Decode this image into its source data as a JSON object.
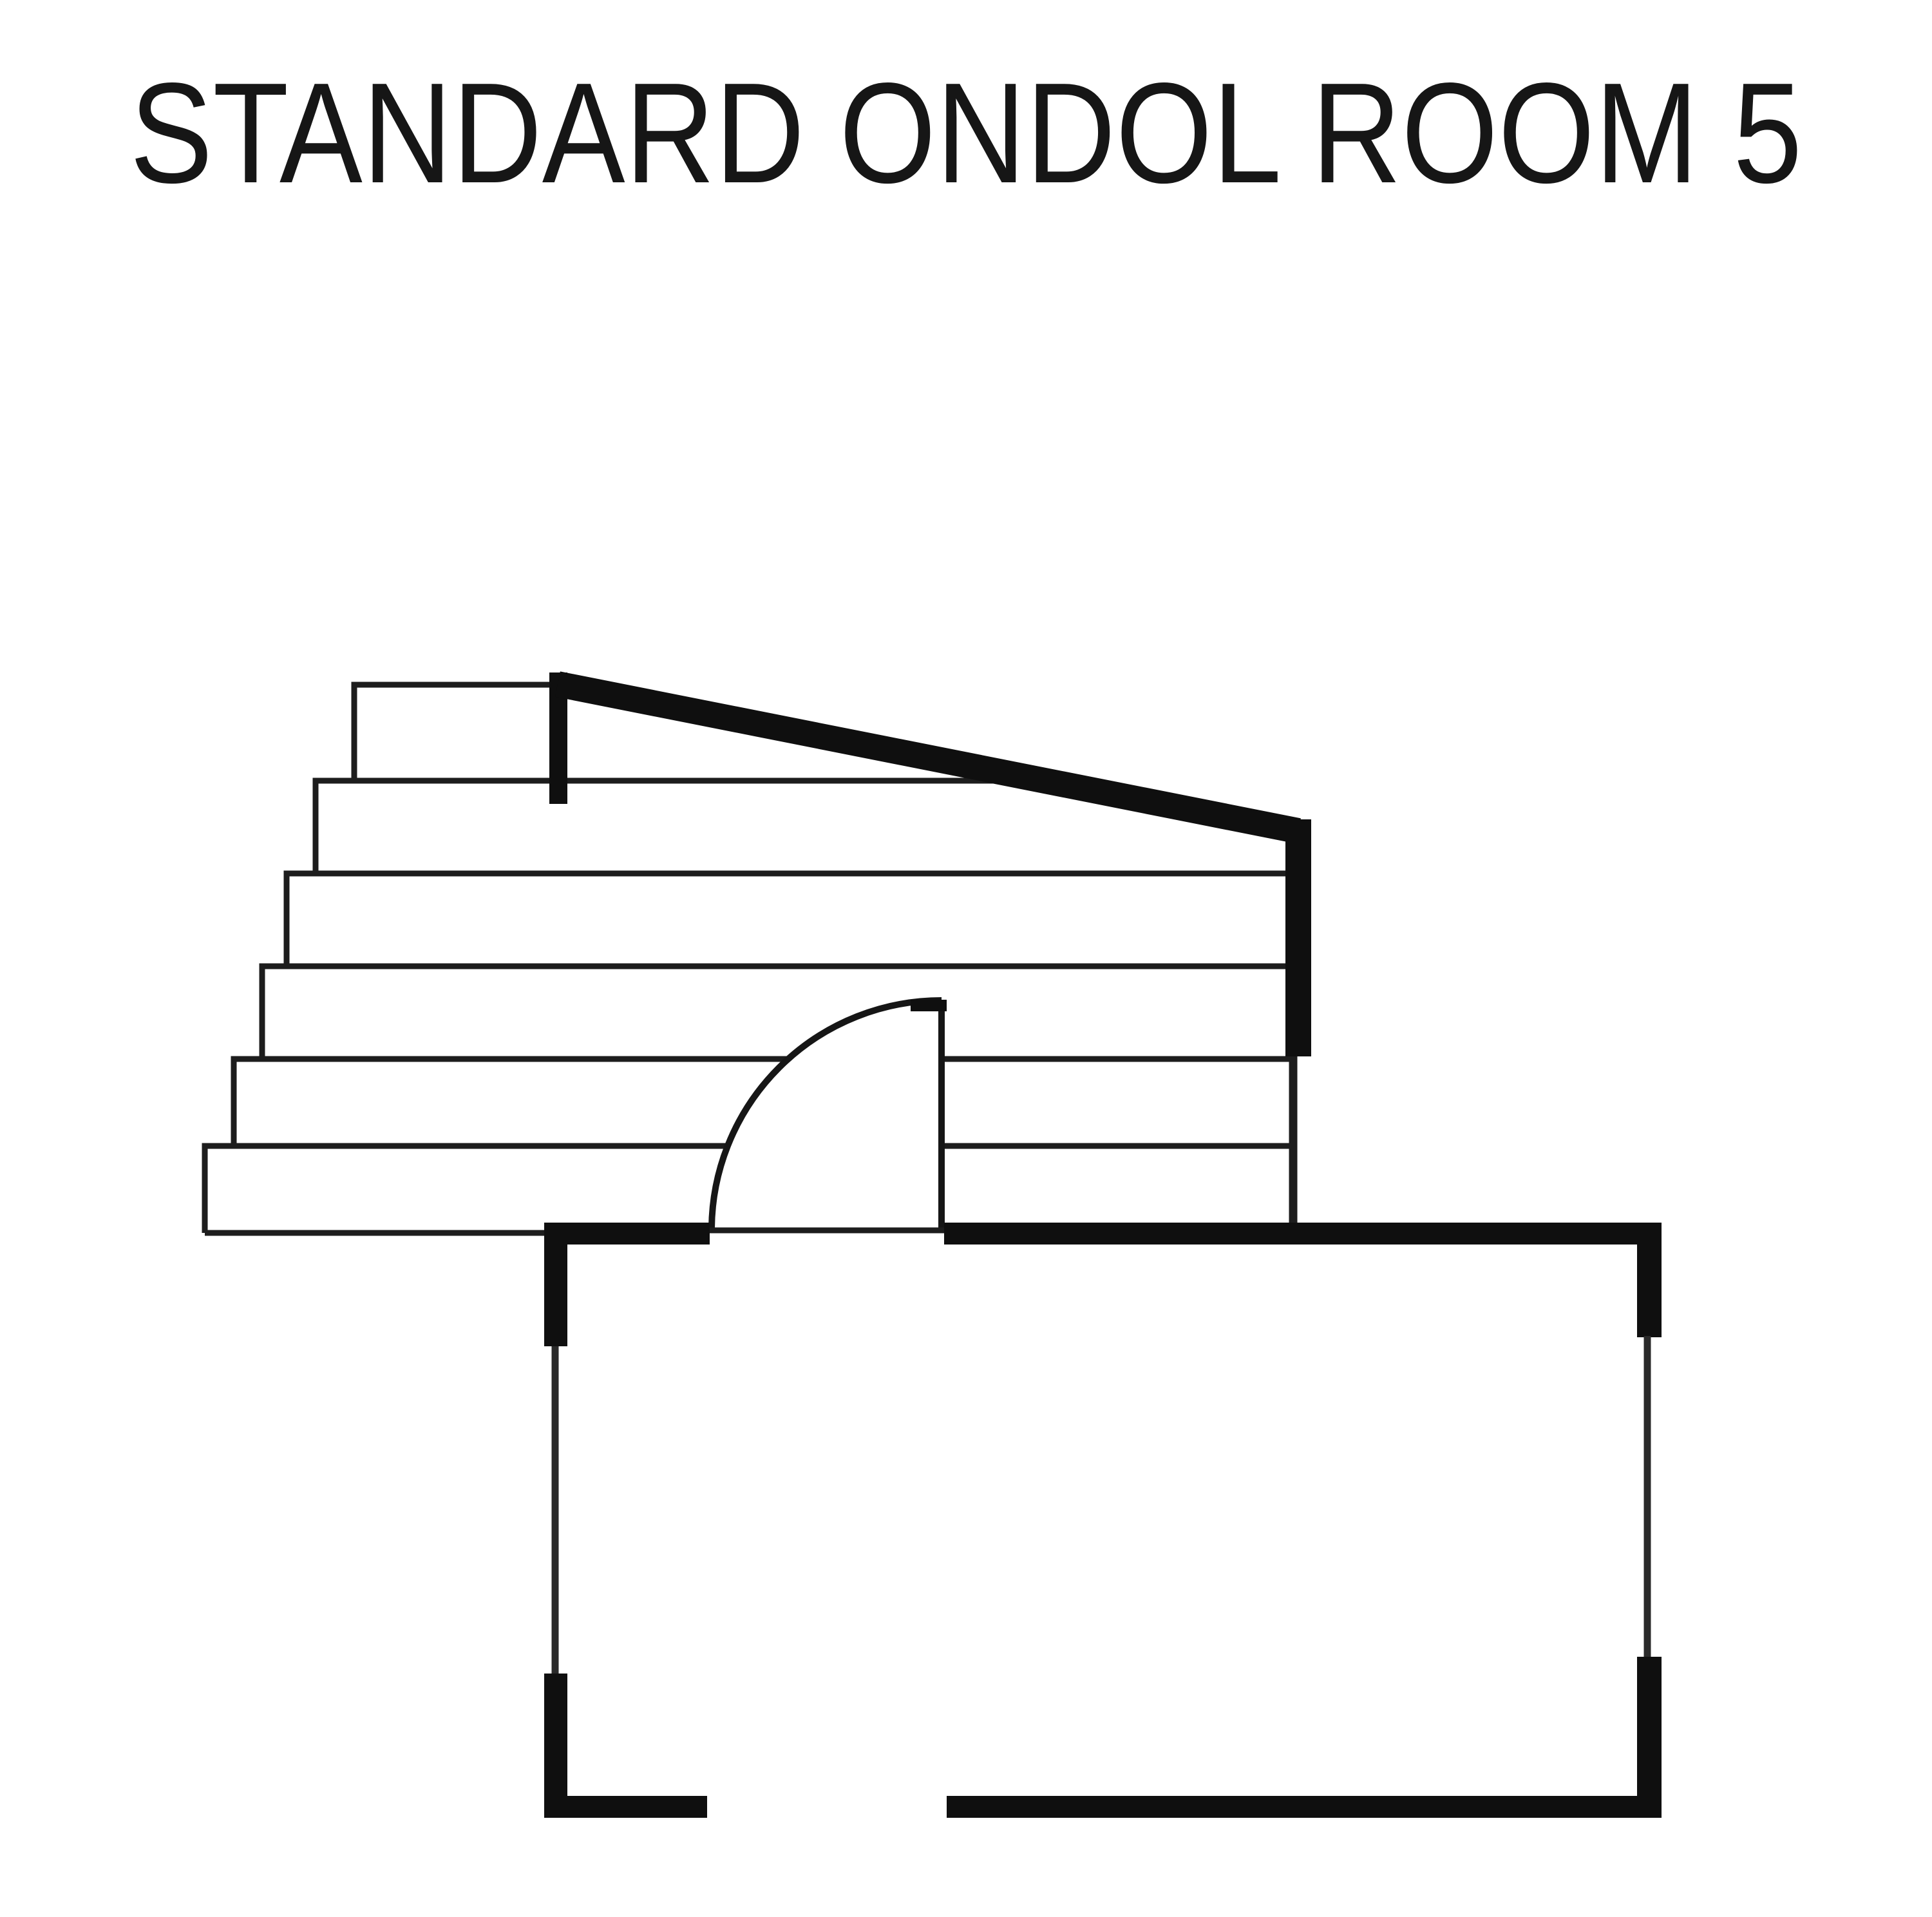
{
  "page": {
    "background_color": "#ffffff",
    "ink_color": "#0f0f0f"
  },
  "header": {
    "title": "STANDARD ONDOL ROOM 5"
  },
  "floor_plan": {
    "label": "Floor plan drawing of Standard Ondol Room 5",
    "staircase": {
      "step_count": 6,
      "description": "Six-step staircase ascending to the upper right"
    },
    "handrail": {
      "description": "Thick diagonal handrail from stair post down to right-side wall"
    },
    "door": {
      "description": "Quarter-circle door swing opening from the room into the stair landing"
    },
    "room": {
      "description": "Rectangular room below the stairs with wall openings at bottom and door opening at top"
    }
  }
}
